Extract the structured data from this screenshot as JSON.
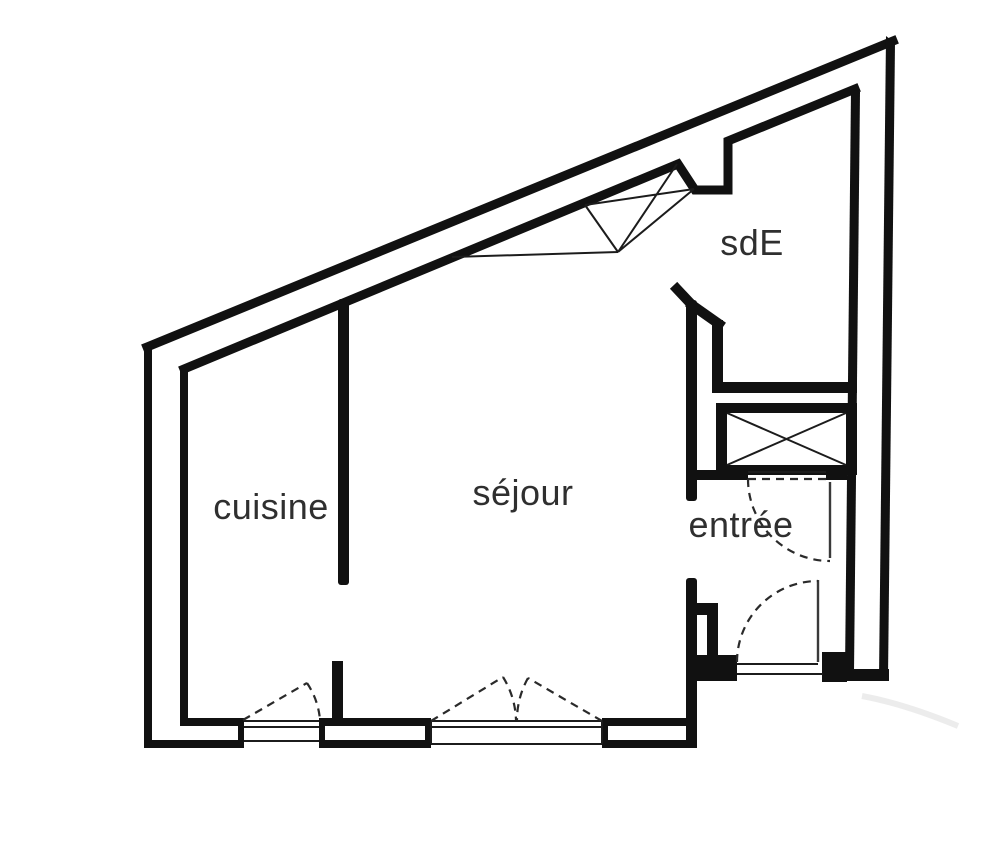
{
  "plan": {
    "background_color": "#ffffff",
    "wall_color": "#111111",
    "label_color": "#2f2f2f",
    "rooms": {
      "cuisine": {
        "label": "cuisine"
      },
      "sejour": {
        "label": "séjour"
      },
      "sde": {
        "label": "sdE"
      },
      "entree": {
        "label": "entrée"
      }
    },
    "symbols": {
      "cuisine_door": "single-swing-door",
      "sejour_door": "double-swing-door",
      "entrance_door": "single-swing-door",
      "sde_door": "single-swing-door",
      "sejour_window": "window-triple-line",
      "cuisine_window": "window-triple-line",
      "closet_box": "crossed-box",
      "roof_window": "crossed-skylight"
    }
  }
}
